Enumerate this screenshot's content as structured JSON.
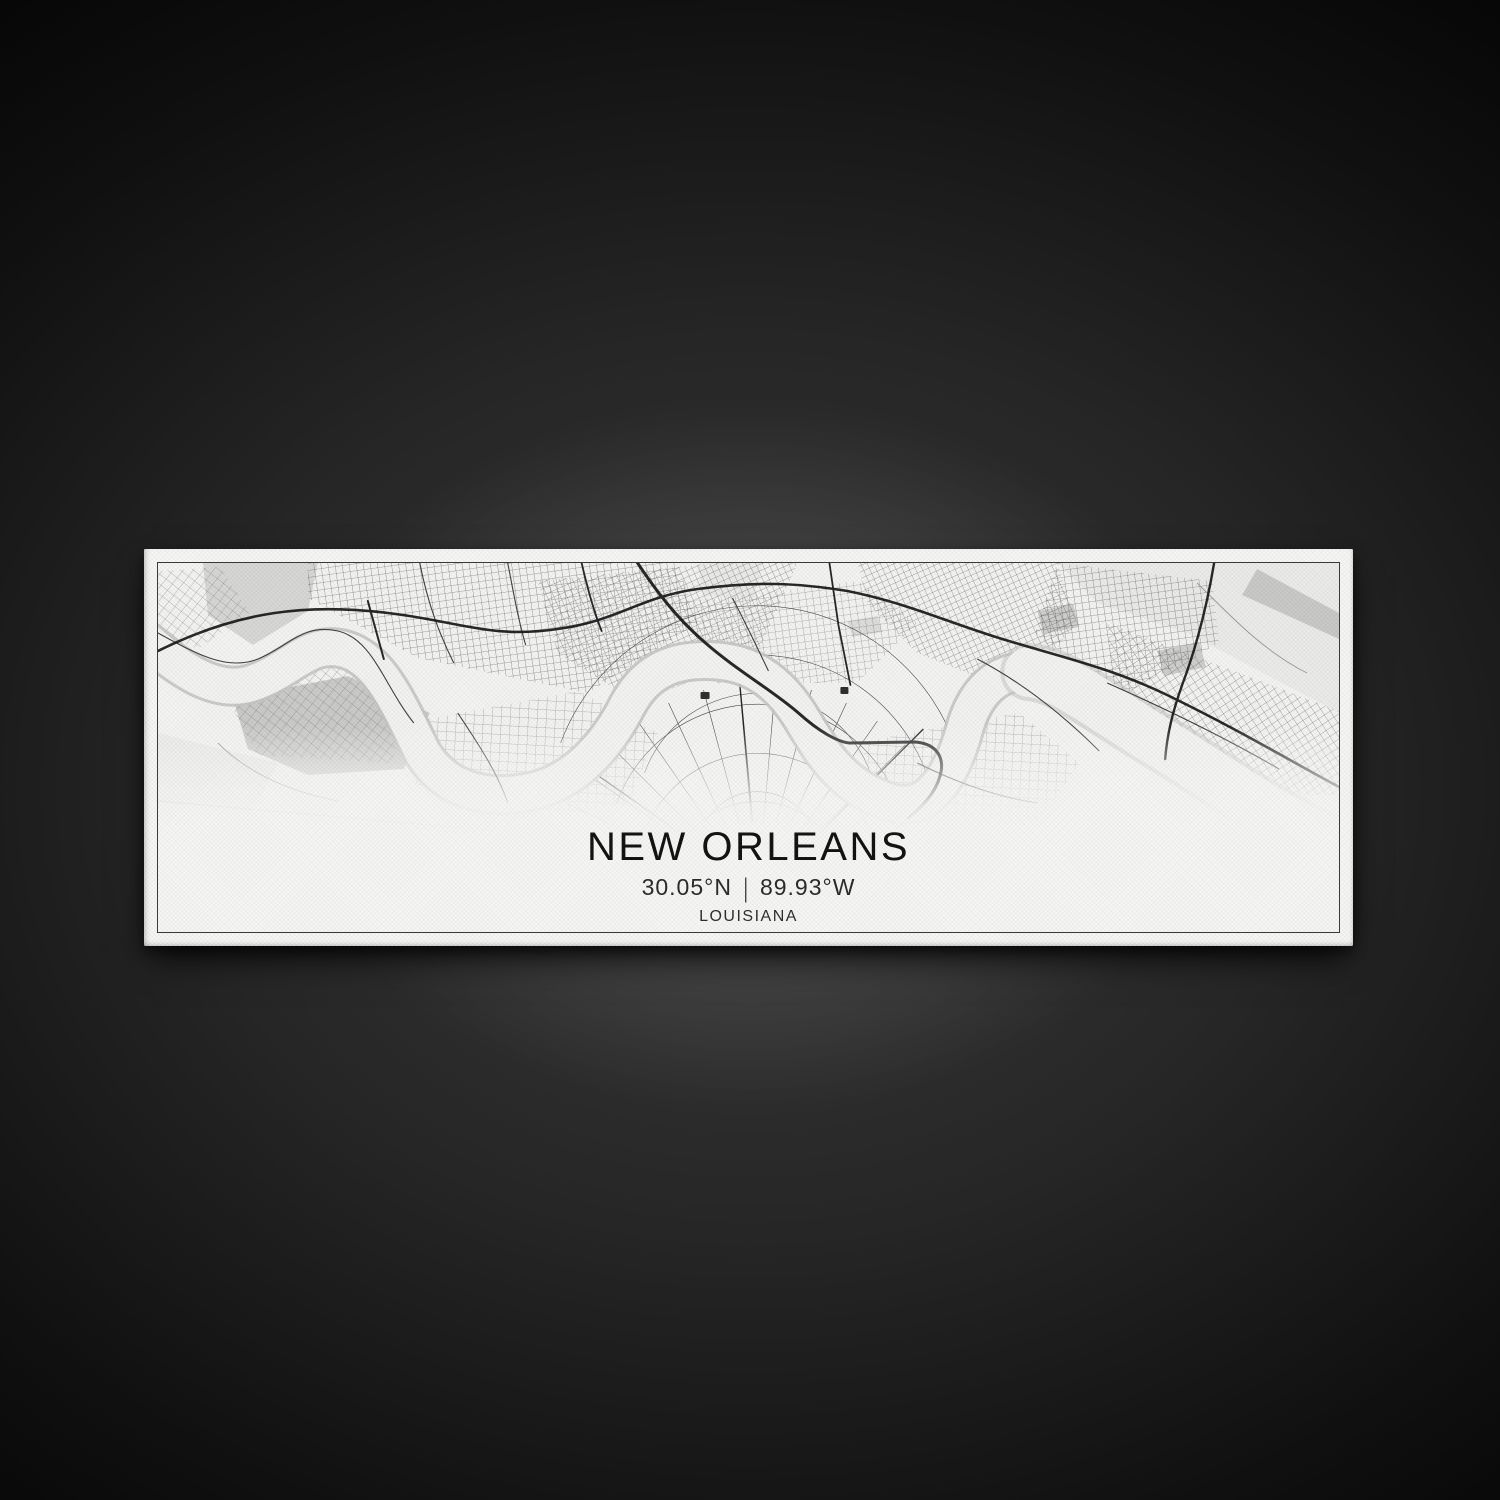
{
  "artwork": {
    "title": "NEW ORLEANS",
    "latitude": "30.05°N",
    "divider": "|",
    "longitude": "89.93°W",
    "state": "LOUISIANA"
  },
  "colors": {
    "background_glow": "#3a3a3a",
    "background_dark": "#060606",
    "canvas_face": "#f6f6f5",
    "map_border": "#3a3a3a",
    "street_ink": "#1b1b1b",
    "water_gray": "#d7d7d6",
    "title_ink": "#121212"
  }
}
